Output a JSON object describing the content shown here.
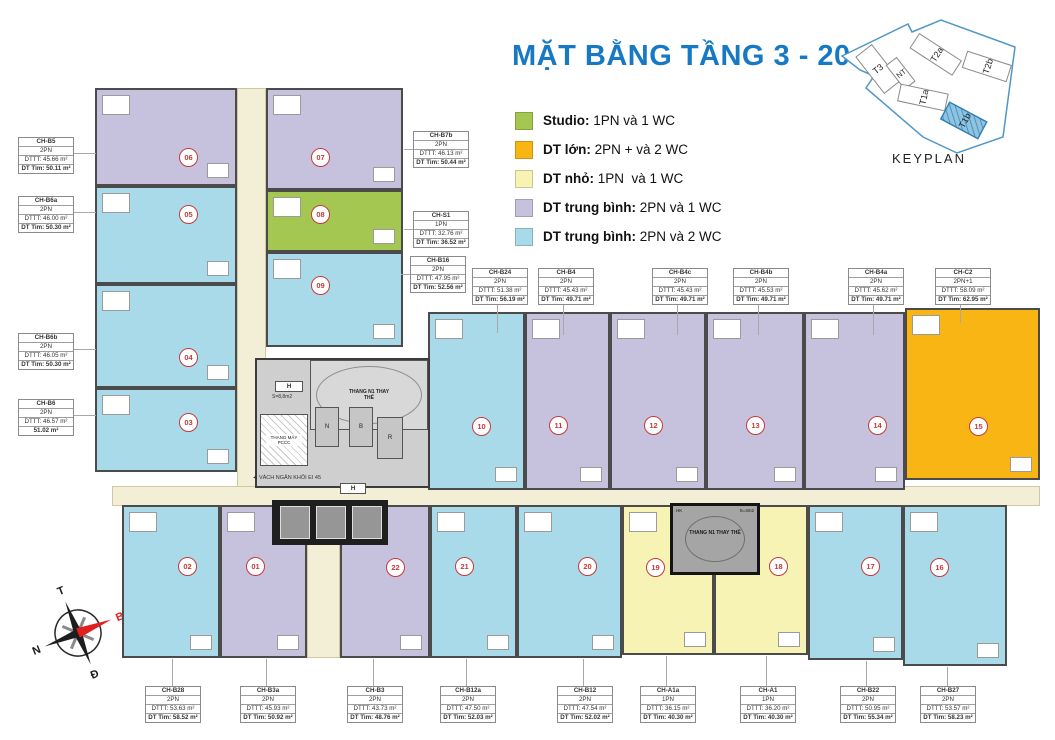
{
  "title": "MẶT BẰNG TẦNG 3 - 20",
  "colors": {
    "studio": "#a4c751",
    "large": "#f9b513",
    "small": "#f6f3b5",
    "medium_1wc": "#c6c1dd",
    "medium_2wc": "#a9daea",
    "corridor": "#f3efd6",
    "wall": "#4b4b4b",
    "title_blue": "#1779c4",
    "circle_red": "#c43b3b",
    "keyplan_blue": "#4f97c8"
  },
  "legend": [
    {
      "label": "Studio:",
      "desc": " 1PN và 1 WC",
      "color": "#a4c751"
    },
    {
      "label": "DT lớn:",
      "desc": " 2PN + và 2 WC",
      "color": "#f9b513"
    },
    {
      "label": "DT nhỏ:",
      "desc": " 1PN  và 1 WC",
      "color": "#f6f3b5"
    },
    {
      "label": "DT trung bình:",
      "desc": " 2PN và 1 WC",
      "color": "#c6c1dd"
    },
    {
      "label": "DT trung bình:",
      "desc": " 2PN và 2 WC",
      "color": "#a9daea"
    }
  ],
  "keyplan": {
    "caption": "KEYPLAN",
    "blocks": [
      {
        "id": "T3"
      },
      {
        "id": "NT"
      },
      {
        "id": "T2a"
      },
      {
        "id": "T2b"
      },
      {
        "id": "T1a"
      },
      {
        "id": "T1b",
        "highlighted": true
      }
    ]
  },
  "compass": {
    "top": "T",
    "right": "B",
    "bottom": "Đ",
    "left": "N"
  },
  "core_texts": {
    "stair_top": "THANG N1 THAY THẾ",
    "stair_bottom": "THANG N1 THAY THẾ",
    "lift_pccc": "THANG MÁY PCCC",
    "partition": "◄ VÁCH NGĂN KHỐI EI 45",
    "h1": "H",
    "h2": "H",
    "s88": "S=8,8m2",
    "s3": "S=3m2",
    "hk": "HK",
    "room_n": "N",
    "room_b": "B",
    "room_r": "R"
  },
  "units": [
    {
      "num": "06",
      "category": "medium_1wc"
    },
    {
      "num": "07",
      "category": "medium_1wc"
    },
    {
      "num": "05",
      "category": "medium_2wc"
    },
    {
      "num": "08",
      "category": "studio"
    },
    {
      "num": "04",
      "category": "medium_2wc"
    },
    {
      "num": "09",
      "category": "medium_2wc"
    },
    {
      "num": "03",
      "category": "medium_2wc"
    },
    {
      "num": "10",
      "category": "medium_2wc"
    },
    {
      "num": "11",
      "category": "medium_1wc"
    },
    {
      "num": "12",
      "category": "medium_1wc"
    },
    {
      "num": "13",
      "category": "medium_1wc"
    },
    {
      "num": "14",
      "category": "medium_1wc"
    },
    {
      "num": "15",
      "category": "large"
    },
    {
      "num": "02",
      "category": "medium_2wc"
    },
    {
      "num": "01",
      "category": "medium_1wc"
    },
    {
      "num": "22",
      "category": "medium_1wc"
    },
    {
      "num": "21",
      "category": "medium_2wc"
    },
    {
      "num": "20",
      "category": "medium_2wc"
    },
    {
      "num": "19",
      "category": "small"
    },
    {
      "num": "18",
      "category": "small"
    },
    {
      "num": "17",
      "category": "medium_2wc"
    },
    {
      "num": "16",
      "category": "medium_2wc"
    }
  ],
  "labels": [
    {
      "name": "CH-B5",
      "type": "2PN",
      "area1": "DTTT: 45.66 m²",
      "area2": "DT Tim: 50.11 m²"
    },
    {
      "name": "CH-B6a",
      "type": "2PN",
      "area1": "DTTT: 46.00 m²",
      "area2": "DT Tim: 50.30 m²"
    },
    {
      "name": "CH-B6b",
      "type": "2PN",
      "area1": "DTTT: 46.05 m²",
      "area2": "DT Tim: 50.30 m²"
    },
    {
      "name": "CH-B6",
      "type": "2PN",
      "area1": "DTTT: 46.57 m²",
      "area2": "51.02 m²"
    },
    {
      "name": "CH-B7b",
      "type": "2PN",
      "area1": "DTTT: 46.13 m²",
      "area2": "DT Tim: 50.44 m²"
    },
    {
      "name": "CH-S1",
      "type": "1PN",
      "area1": "DTTT: 32.76 m²",
      "area2": "DT Tim: 36.52 m²"
    },
    {
      "name": "CH-B16",
      "type": "2PN",
      "area1": "DTTT: 47.95 m²",
      "area2": "DT Tim: 52.56 m²"
    },
    {
      "name": "CH-B24",
      "type": "2PN",
      "area1": "DTTT: 51.38 m²",
      "area2": "DT Tim: 56.19 m²"
    },
    {
      "name": "CH-B4",
      "type": "2PN",
      "area1": "DTTT: 45.43 m²",
      "area2": "DT Tim: 49.71 m²"
    },
    {
      "name": "CH-B4c",
      "type": "2PN",
      "area1": "DTTT: 45.43 m²",
      "area2": "DT Tim: 49.71 m²"
    },
    {
      "name": "CH-B4b",
      "type": "2PN",
      "area1": "DTTT: 45.53 m²",
      "area2": "DT Tim: 49.71 m²"
    },
    {
      "name": "CH-B4a",
      "type": "2PN",
      "area1": "DTTT: 45.62 m²",
      "area2": "DT Tim: 49.71 m²"
    },
    {
      "name": "CH-C2",
      "type": "2PN+1",
      "area1": "DTTT: 58.09 m²",
      "area2": "DT Tim: 62.95 m²"
    },
    {
      "name": "CH-B28",
      "type": "2PN",
      "area1": "DTTT: 53.63 m²",
      "area2": "DT Tim: 58.52 m²"
    },
    {
      "name": "CH-B3a",
      "type": "2PN",
      "area1": "DTTT: 45.93 m²",
      "area2": "DT Tim: 50.92 m²"
    },
    {
      "name": "CH-B3",
      "type": "2PN",
      "area1": "DTTT: 43.73 m²",
      "area2": "DT Tim: 48.76 m²"
    },
    {
      "name": "CH-B12a",
      "type": "2PN",
      "area1": "DTTT: 47.50 m²",
      "area2": "DT Tim: 52.03 m²"
    },
    {
      "name": "CH-B12",
      "type": "2PN",
      "area1": "DTTT: 47.54 m²",
      "area2": "DT Tim: 52.02 m²"
    },
    {
      "name": "CH-A1a",
      "type": "1PN",
      "area1": "DTTT: 36.15 m²",
      "area2": "DT Tim: 40.30 m²"
    },
    {
      "name": "CH-A1",
      "type": "1PN",
      "area1": "DTTT: 36.20 m²",
      "area2": "DT Tim: 40.30 m²"
    },
    {
      "name": "CH-B22",
      "type": "2PN",
      "area1": "DTTT: 50.95 m²",
      "area2": "DT Tim: 55.34 m²"
    },
    {
      "name": "CH-B27",
      "type": "2PN",
      "area1": "DTTT: 53.57 m²",
      "area2": "DT Tim: 58.23 m²"
    }
  ]
}
